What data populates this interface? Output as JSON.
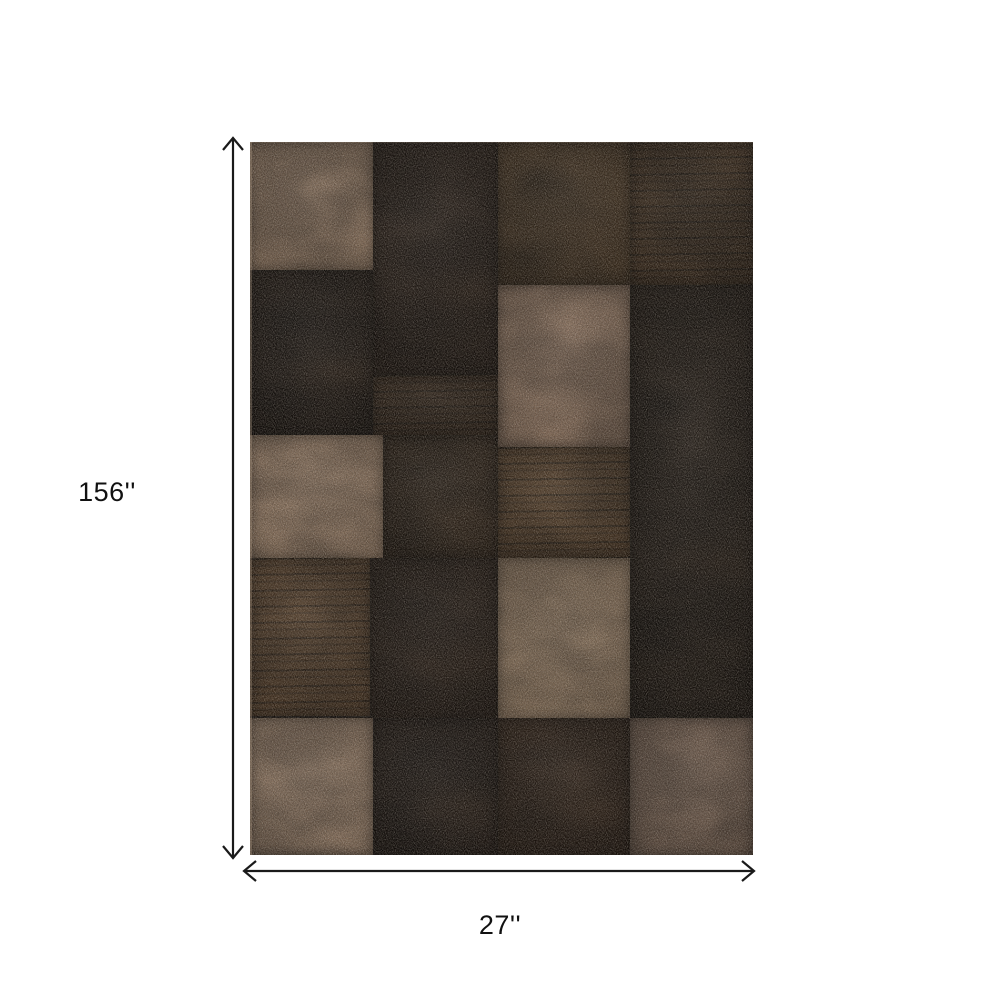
{
  "page": {
    "background_color": "#ffffff"
  },
  "annotations": {
    "height_label": "156''",
    "width_label": "27''",
    "line_color": "#1a1a1a"
  },
  "rug": {
    "description": "rectangular patchwork area rug with tan, medium brown and dark chocolate squares",
    "left": 250,
    "top": 142,
    "width": 503,
    "height": 713,
    "base_color": "#1c1510",
    "palette": {
      "tan": "#a0826a",
      "taupe": "#7d6452",
      "medium_brown": "#533b24",
      "brown": "#46331f",
      "dark_brown": "#2b1c11",
      "near_black": "#1b130d"
    },
    "tiles": [
      {
        "name": "a-tan",
        "x": 0,
        "y": 0,
        "w": 123,
        "h": 128,
        "color": "#997c63",
        "pattern": "plain"
      },
      {
        "name": "b-dark",
        "x": 123,
        "y": 0,
        "w": 125,
        "h": 233,
        "color": "#211710",
        "pattern": "mottle"
      },
      {
        "name": "b2-striated",
        "x": 123,
        "y": 233,
        "w": 125,
        "h": 62,
        "color": "#332315",
        "pattern": "striation"
      },
      {
        "name": "c1-brown",
        "x": 248,
        "y": 0,
        "w": 132,
        "h": 143,
        "color": "#46331f",
        "pattern": "mottle"
      },
      {
        "name": "c2-brown-dark",
        "x": 380,
        "y": 0,
        "w": 123,
        "h": 143,
        "color": "#392818",
        "pattern": "striation"
      },
      {
        "name": "d-black",
        "x": 0,
        "y": 128,
        "w": 123,
        "h": 165,
        "color": "#1b130d",
        "pattern": "mottle"
      },
      {
        "name": "e-tan",
        "x": 248,
        "y": 143,
        "w": 132,
        "h": 162,
        "color": "#957760",
        "pattern": "plain"
      },
      {
        "name": "f-dark-column",
        "x": 380,
        "y": 143,
        "w": 123,
        "h": 433,
        "color": "#1d150e",
        "pattern": "mottle"
      },
      {
        "name": "g-tan",
        "x": 0,
        "y": 293,
        "w": 133,
        "h": 123,
        "color": "#a5866b",
        "pattern": "plain"
      },
      {
        "name": "h-dark",
        "x": 133,
        "y": 293,
        "w": 115,
        "h": 125,
        "color": "#291d12",
        "pattern": "mottle"
      },
      {
        "name": "i-medium-brown",
        "x": 248,
        "y": 305,
        "w": 132,
        "h": 111,
        "color": "#533b24",
        "pattern": "striation"
      },
      {
        "name": "j-striated-brown",
        "x": 0,
        "y": 416,
        "w": 120,
        "h": 158,
        "color": "#553c25",
        "pattern": "striation"
      },
      {
        "name": "k-dark",
        "x": 120,
        "y": 416,
        "w": 128,
        "h": 162,
        "color": "#231810",
        "pattern": "mottle"
      },
      {
        "name": "l-tan",
        "x": 248,
        "y": 416,
        "w": 132,
        "h": 162,
        "color": "#a18467",
        "pattern": "plain"
      },
      {
        "name": "n-tan",
        "x": 0,
        "y": 576,
        "w": 123,
        "h": 137,
        "color": "#9e8168",
        "pattern": "plain"
      },
      {
        "name": "o-dark",
        "x": 123,
        "y": 576,
        "w": 125,
        "h": 137,
        "color": "#1d140e",
        "pattern": "mottle"
      },
      {
        "name": "p-dark-brown",
        "x": 248,
        "y": 576,
        "w": 132,
        "h": 137,
        "color": "#2b1c11",
        "pattern": "mottle"
      },
      {
        "name": "q-taupe",
        "x": 380,
        "y": 576,
        "w": 123,
        "h": 137,
        "color": "#7d6452",
        "pattern": "plain"
      }
    ]
  }
}
